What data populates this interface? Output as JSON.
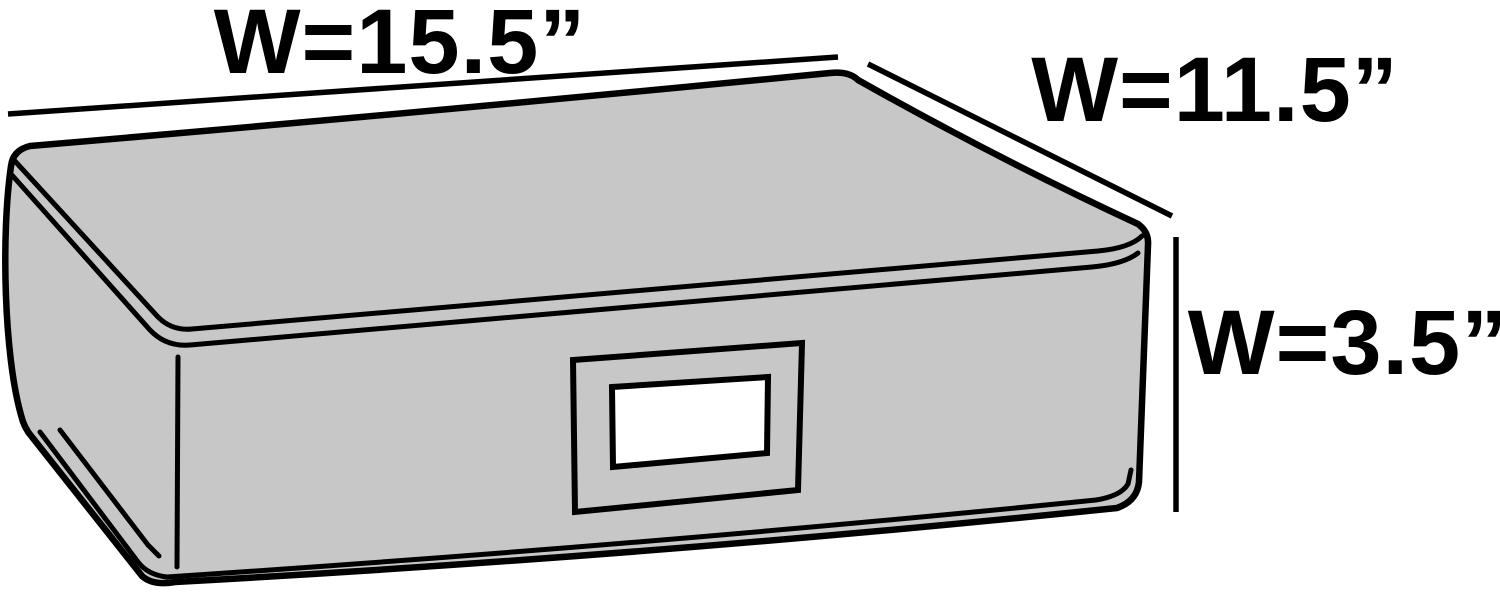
{
  "diagram": {
    "title": "Underbed storage box dimension diagram",
    "labels": {
      "width": "W=15.5”",
      "depth": "W=11.5”",
      "height": "W=3.5”"
    },
    "colors": {
      "background": "#ffffff",
      "box_fill": "#c7c7c7",
      "outline": "#000000",
      "label_window_fill": "#ffffff"
    }
  }
}
